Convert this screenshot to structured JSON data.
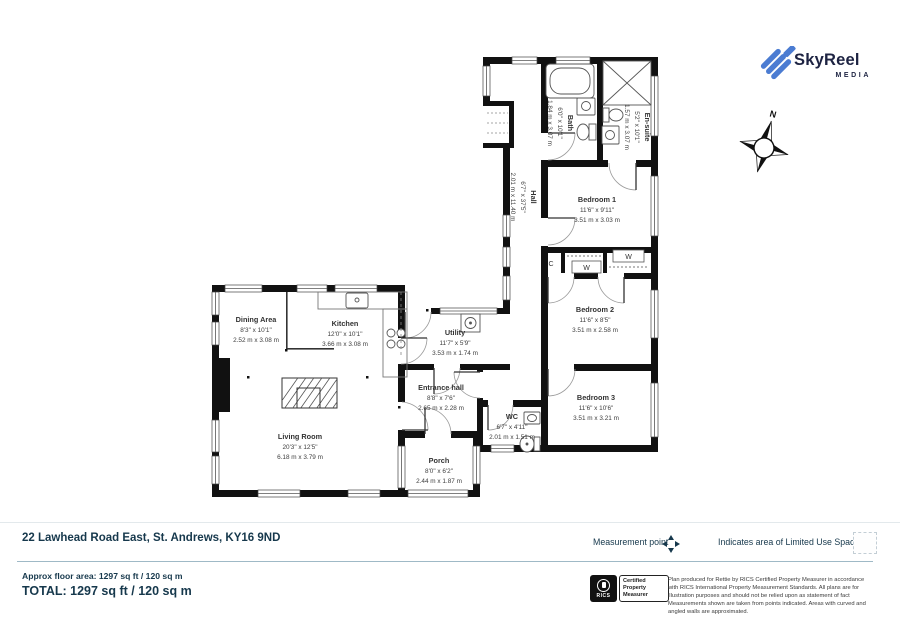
{
  "brand": {
    "name": "SkyReel",
    "sub": "MEDIA"
  },
  "compass": {
    "north": "N"
  },
  "rooms": [
    {
      "name": "Dining Area",
      "dims_ft": "8'3\" x 10'1\"",
      "dims_m": "2.52 m x 3.08 m"
    },
    {
      "name": "Kitchen",
      "dims_ft": "12'0\" x 10'1\"",
      "dims_m": "3.66 m x 3.08 m"
    },
    {
      "name": "Living Room",
      "dims_ft": "20'3\" x 12'5\"",
      "dims_m": "6.18 m x 3.79 m"
    },
    {
      "name": "Utility",
      "dims_ft": "11'7\" x 5'9\"",
      "dims_m": "3.53 m x 1.74 m"
    },
    {
      "name": "Entrance hall",
      "dims_ft": "8'8\" x 7'6\"",
      "dims_m": "2.65 m x 2.28 m"
    },
    {
      "name": "WC",
      "dims_ft": "6'7\" x 4'11\"",
      "dims_m": "2.01 m x 1.51 m"
    },
    {
      "name": "Porch",
      "dims_ft": "8'0\" x 6'2\"",
      "dims_m": "2.44 m x 1.87 m"
    },
    {
      "name": "Bedroom 1",
      "dims_ft": "11'6\" x 9'11\"",
      "dims_m": "3.51 m x 3.03 m"
    },
    {
      "name": "Bedroom 2",
      "dims_ft": "11'6\" x 8'5\"",
      "dims_m": "3.51 m x 2.58 m"
    },
    {
      "name": "Bedroom 3",
      "dims_ft": "11'6\" x 10'6\"",
      "dims_m": "3.51 m x 3.21 m"
    },
    {
      "name": "Hall",
      "dims_ft": "6'7\" x 37'5\"",
      "dims_m": "2.01 m x 11.40 m"
    },
    {
      "name": "Bath",
      "dims_ft": "6'0\" x 10'1\"",
      "dims_m": "1.84 m x 3.07 m"
    },
    {
      "name": "En-suite",
      "dims_ft": "5'2\" x 10'1\"",
      "dims_m": "1.57 m x 3.07 m"
    }
  ],
  "closets": [
    {
      "label": "C"
    },
    {
      "label": "W"
    },
    {
      "label": "W"
    }
  ],
  "legend": {
    "measurement": "Measurement point",
    "limited": "Indicates area of Limited Use Space"
  },
  "address": "22 Lawhead Road East, St. Andrews, KY16 9ND",
  "area": {
    "approx": "Approx floor area: 1297 sq ft / 120 sq m",
    "total": "TOTAL: 1297 sq ft / 120 sq m"
  },
  "rics": {
    "org": "RICS",
    "badge": "Certified Property Measurer",
    "disclaimer": "Plan produced for Rettie by RICS Certified Property Measurer in accordance with RICS International Property Measurement Standards. All plans are for illustration purposes and should not be relied upon as statement of fact Measurements shown are taken from points indicated. Areas with curved and angled walls are approximated."
  },
  "colors": {
    "accent": "#16384c",
    "wall": "#111111",
    "logo_blue": "#4b7cd2",
    "separator": "#9fb9c6"
  }
}
